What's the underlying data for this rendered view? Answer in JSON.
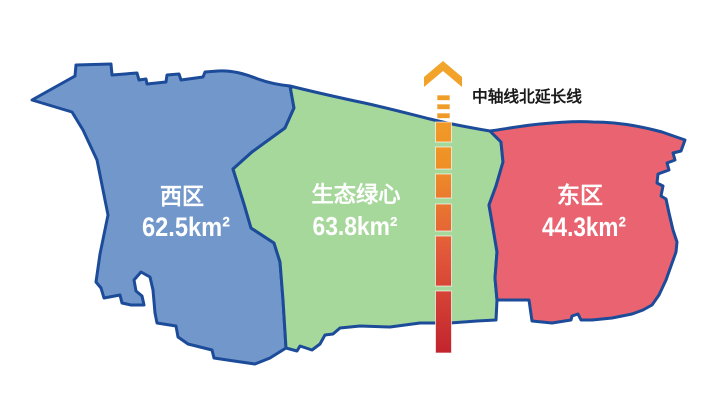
{
  "map": {
    "background_color": "#ffffff",
    "outline_color": "#1c4b99",
    "regions": [
      {
        "id": "west-district",
        "name": "西区",
        "area": "62.5km²",
        "fill_color": "#7297cb",
        "label_color": "#ffffff"
      },
      {
        "id": "ecological-green-heart",
        "name": "生态绿心",
        "area": "63.8km²",
        "fill_color": "#a6d79b",
        "label_color": "#ffffff"
      },
      {
        "id": "east-district",
        "name": "东区",
        "area": "44.3km²",
        "fill_color": "#e96370",
        "label_color": "#ffffff"
      }
    ],
    "axis": {
      "label": "中轴线北延长线",
      "label_color": "#1a1a1a",
      "direction": "north",
      "arrow_icon": "chevron-up",
      "gradient_colors": [
        "#f2a62b",
        "#ef9126",
        "#e2593a",
        "#c2242e"
      ]
    }
  }
}
